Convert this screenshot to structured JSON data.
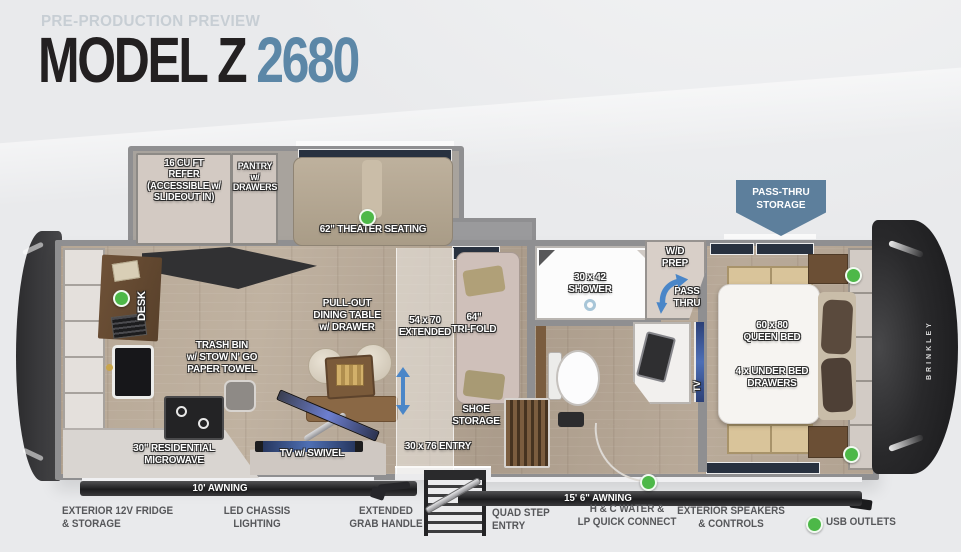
{
  "header": {
    "eyebrow": "PRE-PRODUCTION PREVIEW",
    "model": "MODEL Z",
    "floorplan_number": "2680"
  },
  "colors": {
    "accent_blue": "#5c87a7",
    "badge_blue": "#5d7f9c",
    "usb_green": "#4db848",
    "title_dark": "#232021",
    "background": "#e9eaec"
  },
  "floorplan": {
    "brand": "BRINKLEY",
    "badge": "PASS-THRU\nSTORAGE",
    "awning_left": "10' AWNING",
    "awning_right": "15' 6\" AWNING",
    "labels": {
      "refer": "16 CU FT\nREFER\n(ACCESSIBLE w/\nSLIDEOUT IN)",
      "pantry": "PANTRY\nw/\nDRAWERS",
      "theater": "62\" THEATER SEATING",
      "desk": "DESK",
      "trash": "TRASH BIN\nw/ STOW N' GO\nPAPER TOWEL",
      "microwave": "30\" RESIDENTIAL\nMICROWAVE",
      "tv_swivel": "TV w/ SWIVEL",
      "dining": "PULL-OUT\nDINING TABLE\nw/ DRAWER",
      "extended": "54 x 70\nEXTENDED",
      "trifold": "64\"\nTRI-FOLD",
      "shoe_storage": "SHOE\nSTORAGE",
      "entry": "30 x 76 ENTRY",
      "shower": "30 x 42\nSHOWER",
      "wd_prep": "W/D\nPREP",
      "pass_thru": "PASS\nTHRU",
      "tv": "TV",
      "queen_bed": "60 x 80\nQUEEN BED",
      "under_bed": "4 x UNDER BED\nDRAWERS"
    }
  },
  "callouts": {
    "items": [
      {
        "text": "EXTERIOR 12V FRIDGE\n& STORAGE"
      },
      {
        "text": "LED CHASSIS\nLIGHTING"
      },
      {
        "text": "EXTENDED\nGRAB HANDLE"
      },
      {
        "text": "QUAD STEP\nENTRY"
      },
      {
        "text": "H & C WATER &\nLP QUICK CONNECT"
      },
      {
        "text": "EXTERIOR SPEAKERS\n& CONTROLS"
      }
    ],
    "legend": {
      "label": "USB OUTLETS"
    }
  }
}
